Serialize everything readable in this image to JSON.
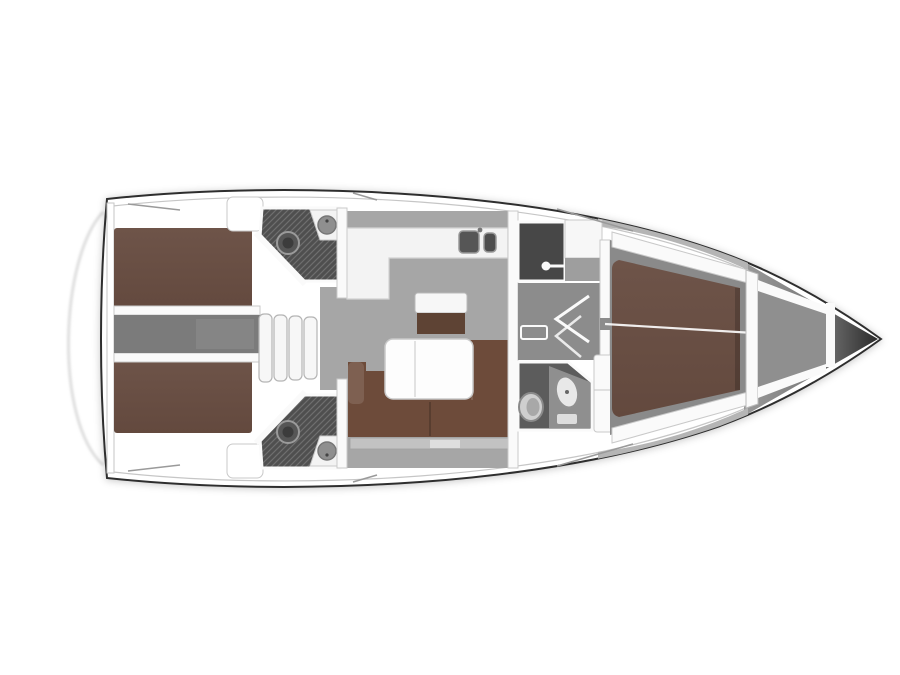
{
  "diagram": {
    "type": "boat-floor-plan",
    "view": "top-down, bow pointing right",
    "regions": [
      {
        "id": "transom-platform"
      },
      {
        "id": "aft-cabin-port",
        "furniture": "double-berth"
      },
      {
        "id": "aft-cabin-starboard",
        "furniture": "double-berth"
      },
      {
        "id": "aft-head-port",
        "fixtures": [
          "sink",
          "toilet",
          "shower-floor"
        ]
      },
      {
        "id": "aft-head-starboard",
        "fixtures": [
          "sink",
          "toilet",
          "shower-floor"
        ]
      },
      {
        "id": "engine-walkway"
      },
      {
        "id": "companionway-steps",
        "step_count": 4
      },
      {
        "id": "galley",
        "fixtures": [
          "double-sink"
        ]
      },
      {
        "id": "salon",
        "furniture": [
          "l-sofa",
          "folding-table",
          "mast-bench"
        ]
      },
      {
        "id": "shower-room",
        "fixtures": [
          "shower-head"
        ]
      },
      {
        "id": "wardrobe"
      },
      {
        "id": "corridor",
        "details": [
          "door-swing-arrows",
          "floor-hatch"
        ]
      },
      {
        "id": "forward-head",
        "fixtures": [
          "toilet",
          "sink",
          "cabinet"
        ]
      },
      {
        "id": "forward-cabin",
        "furniture": "v-berth"
      },
      {
        "id": "anchor-locker"
      },
      {
        "id": "bow-tip"
      }
    ]
  },
  "counts": {
    "cabins": 3,
    "heads": 3,
    "companionway_steps": 4,
    "galley_sinks": 2
  },
  "colors": {
    "background": "#ffffff",
    "hull_outline": "#2e2e2e",
    "hull_white": "#ffffff",
    "seam_gray": "#c6c6c6",
    "floor_gray": "#a6a6a6",
    "walkway_gray": "#7b7b7b",
    "corridor_gray": "#8c8c8c",
    "head_floor": "#4f4f4f",
    "hatch_line": "#6e6e6e",
    "shower_floor": "#474747",
    "bed_brown": "#6e5449",
    "bed_brown_dark": "#54423a",
    "sofa_brown": "#6d4b3a",
    "sofa_brown_dark": "#5e4334",
    "furniture_white": "#f7f7f7",
    "counter_white": "#f3f3f3",
    "wardrobe_gray": "#9e9e9e",
    "fixture_gray": "#8f8f8f",
    "basin_dark": "#565656",
    "bow_gray": "#989898",
    "bow_dark": "#2b2b2b",
    "wall_white": "#fafafa",
    "wall_stroke": "#c9c9c9",
    "detail_line": "#9a9a9a",
    "deck_shade": "#b5b5b5",
    "transom_line": "#d8d8d8"
  }
}
